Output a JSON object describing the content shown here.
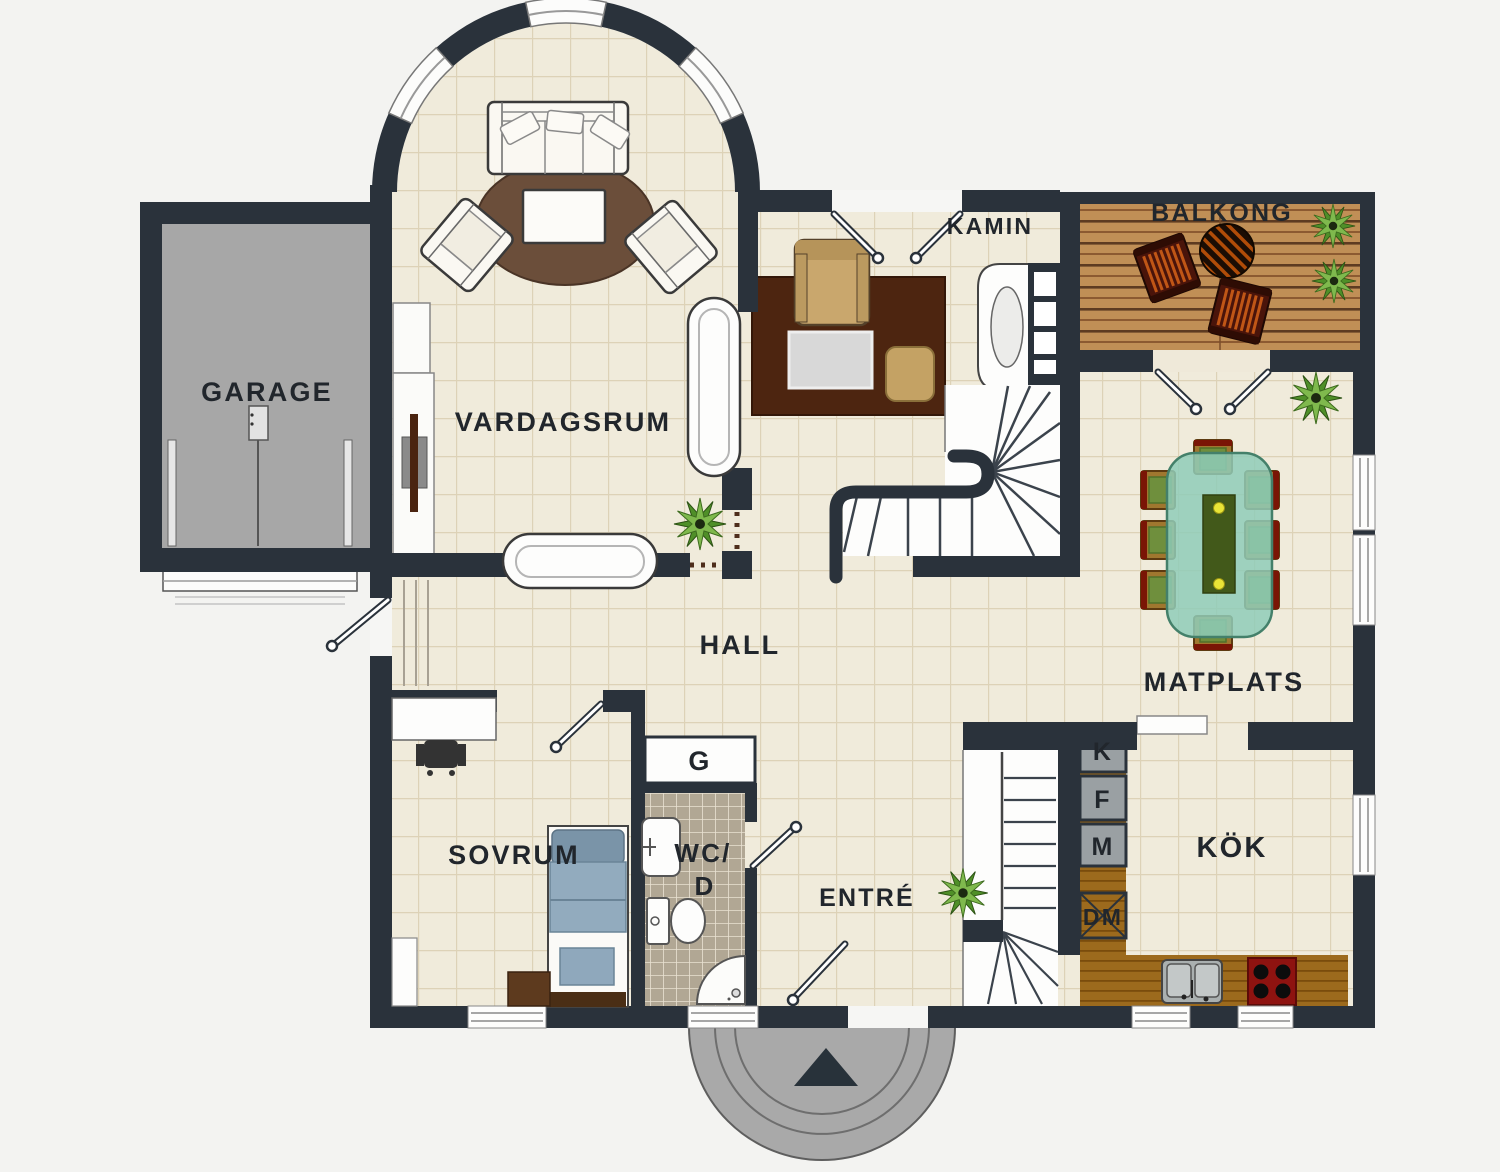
{
  "labels": {
    "garage": "GARAGE",
    "living_room": "VARDAGSRUM",
    "fireplace": "KAMIN",
    "balcony": "BALKONG",
    "hall": "HALL",
    "dining": "MATPLATS",
    "bedroom": "SOVRUM",
    "bath_line1": "WC/",
    "bath_line2": "D",
    "closet": "G",
    "entry": "ENTRÉ",
    "kitchen": "KÖK",
    "appliance_k": "K",
    "appliance_f": "F",
    "appliance_m": "M",
    "dishwasher": "DM"
  },
  "colors": {
    "wall": "#2a323b",
    "floor_tile": "#f0ebdb",
    "tile_grout": "#ddd2b7",
    "garage_floor": "#a7a7a7",
    "porch": "#a9a9a9",
    "deck_wood": "#c08f56",
    "kitchen_counter": "#9c6a1d",
    "stove": "#8e1310",
    "dining_table": "#8fccb8",
    "bed": "#92abbe",
    "wc_tile": "#b1a794",
    "rug_living": "#6b4e3a",
    "rug_fireplace": "#4d2510",
    "plant": "#5e9e2e"
  }
}
